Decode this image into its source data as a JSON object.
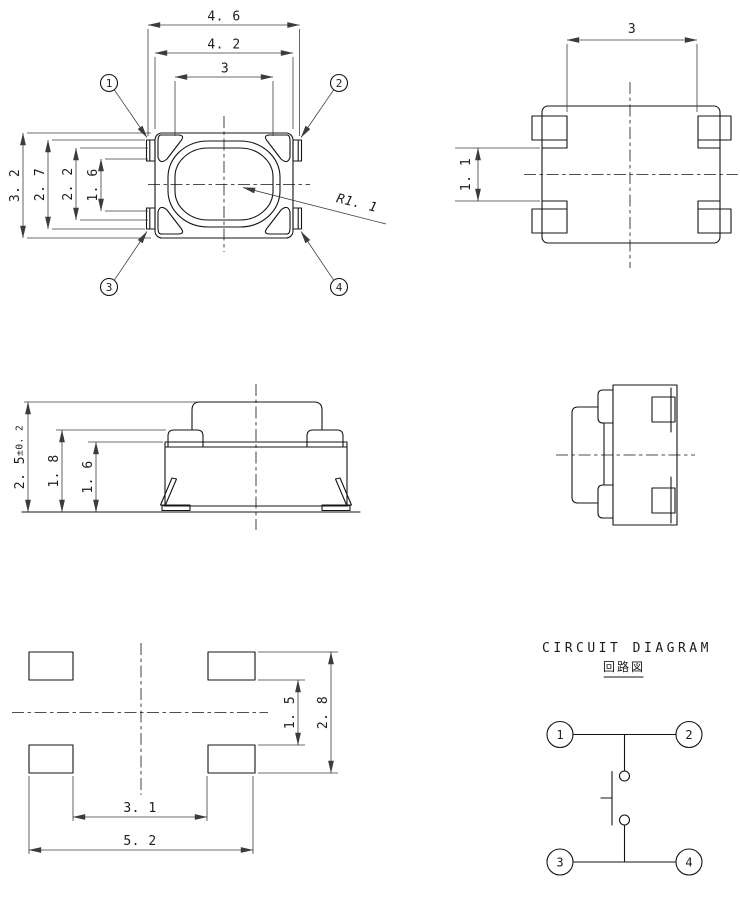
{
  "colors": {
    "line": "#141414",
    "dim": "#3c3c3c",
    "bg": "#ffffff"
  },
  "top_view": {
    "dim_width_outer": "4. 6",
    "dim_width_body": "4. 2",
    "dim_width_button": "3",
    "dim_height_body": "3. 2",
    "dim_height_terminals": "2. 7",
    "dim_height_inner": "2. 2",
    "dim_height_center": "1. 6",
    "radius_label": "R1. 1",
    "pins": [
      "1",
      "2",
      "3",
      "4"
    ]
  },
  "bottom_view": {
    "dim_width": "3",
    "dim_terminal_gap": "1. 1"
  },
  "front_view": {
    "dim_height": "2. 5",
    "dim_height_tolerance": "±0. 2",
    "dim_cover_height": "1. 8",
    "dim_body_height": "1. 6"
  },
  "land_pattern": {
    "dim_pad_gap_v": "1. 5",
    "dim_pad_span_v": "2. 8",
    "dim_pad_gap_h": "3. 1",
    "dim_pad_span_h": "5. 2"
  },
  "circuit": {
    "title": "CIRCUIT DIAGRAM",
    "subtitle_jp": "回路図",
    "pins": [
      "1",
      "2",
      "3",
      "4"
    ]
  }
}
